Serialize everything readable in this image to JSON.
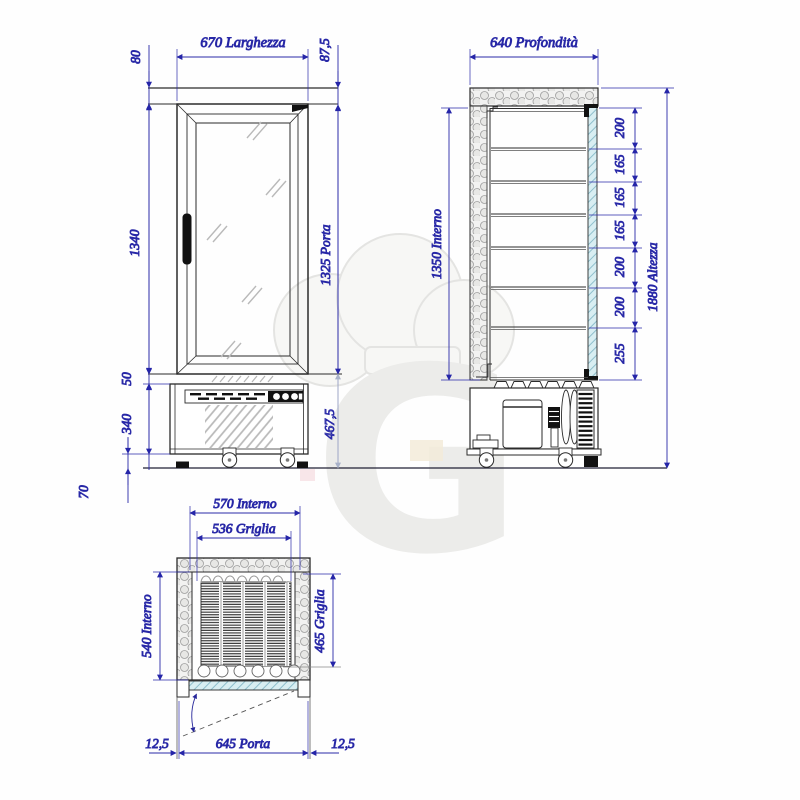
{
  "drawing": {
    "front": {
      "width": "670 Larghezza",
      "cap": "80",
      "cap_right": "87,5",
      "body": "1340",
      "door": "1325 Porta",
      "gap": "50",
      "base": "340",
      "clearance": "70",
      "base_right": "467,5"
    },
    "side": {
      "depth": "640 Profondità",
      "interior": "1350 Interno",
      "height": "1880 Altezza",
      "gaps": [
        "200",
        "165",
        "165",
        "165",
        "200",
        "200",
        "255"
      ]
    },
    "plan": {
      "interior_w": "570 Interno",
      "grid_w": "536 Griglia",
      "interior_d": "540 Interno",
      "grid_d": "465 Griglia",
      "door": "645 Porta",
      "off_l": "12,5",
      "off_r": "12,5"
    },
    "watermark": "G"
  },
  "colors": {
    "dim_blue": "#1c1c9e",
    "dim_light": "#a9b2c9",
    "object_line": "#2b2b2b",
    "glass": "#d8eef2",
    "watermark": "#ececea"
  }
}
